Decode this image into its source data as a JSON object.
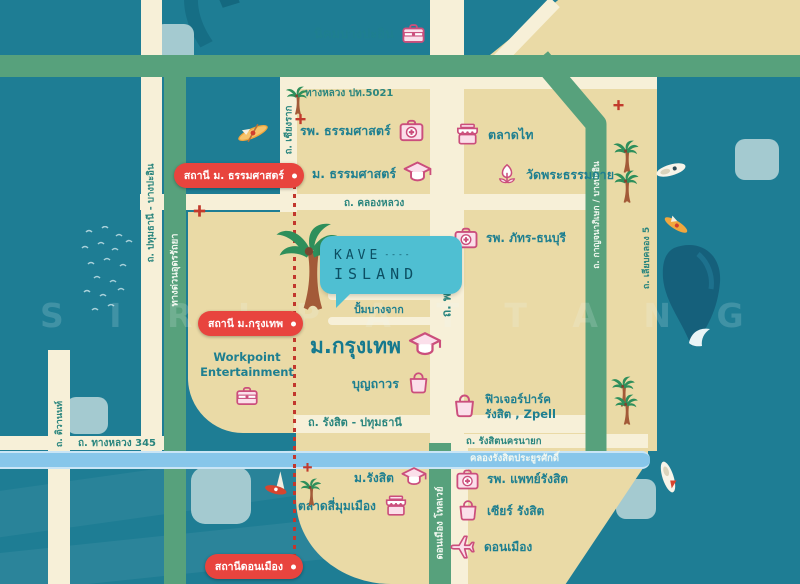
{
  "logo": {
    "name": "KAVE",
    "dashes": "----",
    "island": "ISLAND"
  },
  "watermark": "S I R I P A T T A N G",
  "stations": {
    "thammasat": "สถานี ม. ธรรมศาสตร์",
    "bangkok_u": "สถานี ม.กรุงเทพ",
    "don_mueang": "สถานีดอนเมือง"
  },
  "places": {
    "nikhom_bang_pa_in": "นิคมบางปะอิน",
    "thammasat_hospital": "รพ. ธรรมศาสตร์",
    "thammasat_university": "ม. ธรรมศาสตร์",
    "talad_thai": "ตลาดไท",
    "wat_phra_dhammakaya": "วัดพระธรรมกาย",
    "pat_thonburi_hospital": "รพ. ภัทร-ธนบุรี",
    "mingle_mall": "Mingle Mall",
    "bangchak_gas_station": "ปั้มบางจาก",
    "bangkok_university": "ม.กรุงเทพ",
    "boonthavorn": "บุญถาวร",
    "workpoint": "Workpoint Entertainment",
    "future_park": "ฟิวเจอร์ปาร์ค รังสิต , Zpell",
    "rangsit_university": "ม.รังสิต",
    "talad_si_mum_mueang": "ตลาดสี่มุมเมือง",
    "rangsit_medical_hospital": "รพ. แพทย์รังสิต",
    "zeer_rangsit": "เซียร์ รังสิต",
    "don_mueang_airport": "ดอนเมือง"
  },
  "roads": {
    "highway_5021": "ทางหลวง ปท.5021",
    "chiang_rak": "ถ. เชียงราก",
    "khlong_luang": "ถ. คลองหลวง",
    "pathum_bang_pa_in": "ถ. ปทุมธานี - บางปะอิน",
    "udon_ratthaya": "ทางด่วนอุดรรัถยา",
    "phahonyothin": "ถ. พหลโยธิน",
    "kanchanaphisek": "ถ. กาญจนาภิเษก / บางปะอิน",
    "liab_khlong_5": "ถ. เลียบคลอง 5",
    "rangsit_pathum": "ถ. รังสิต - ปทุมธานี",
    "rangsit_nakhon_nayok": "ถ. รังสิตนครนายก",
    "khlong_rangsit_canal": "คลองรังสิตประยูรศักดิ์",
    "highway_345": "ถ. ทางหลวง 345",
    "tiwanon": "ถ. ติวานนท์",
    "don_mueang_tollway": "ดอนเมือง โทลเวย์"
  },
  "colors": {
    "water": "#1E7D94",
    "land": "#EADAA6",
    "road": "#F7F0D8",
    "green_road": "#57A17C",
    "canal": "#87C6EA",
    "label_teal": "#1E7F90",
    "badge_red": "#E8443E",
    "icon_pink": "#CB4E7C",
    "logo_bubble": "#4FBFD2",
    "rail_red": "#C2372D"
  }
}
